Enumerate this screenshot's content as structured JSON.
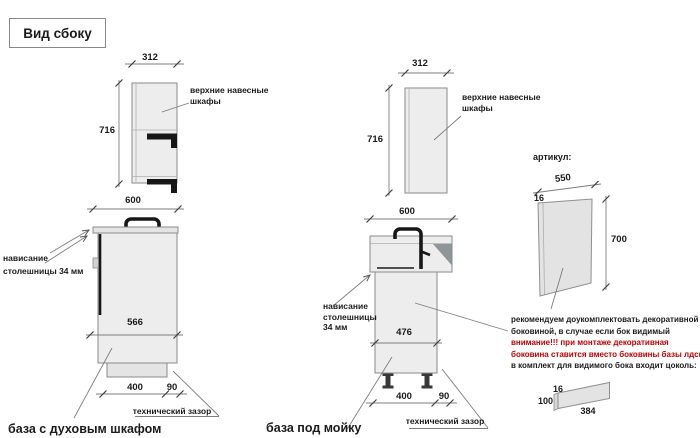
{
  "title": "Вид сбоку",
  "left": {
    "wall": {
      "width": "312",
      "height": "716",
      "label_line1": "верхние навесные",
      "label_line2": "шкафы"
    },
    "base": {
      "width": "600",
      "front_height": "566",
      "door_width": "400",
      "gap": "90",
      "overhang_line1": "нависание",
      "overhang_line2": "столешницы 34 мм",
      "gap_label": "технический зазор",
      "caption": "база с духовым шкафом"
    }
  },
  "middle": {
    "wall": {
      "width": "312",
      "height": "716",
      "label_line1": "верхние навесные",
      "label_line2": "шкафы"
    },
    "base": {
      "width": "600",
      "front_height": "476",
      "door_width": "400",
      "gap": "90",
      "overhang_line1": "нависание",
      "overhang_line2": "столешницы",
      "overhang_line3": "34 мм",
      "gap_label": "технический зазор",
      "caption": "база под мойку"
    }
  },
  "right": {
    "article_label": "артикул:",
    "panel": {
      "width": "550",
      "thickness": "16",
      "height": "700"
    },
    "note": {
      "line1": "рекомендуем доукомплектовать декоративной",
      "line2": "боковиной, в случае если бок видимый",
      "line3": "внимание!!! при монтаже декоративная",
      "line4": "боковина ставится вместо боковины базы лдсп",
      "line5": "в комплект для видимого бока входит цоколь:"
    },
    "plinth": {
      "thickness": "16",
      "height": "100",
      "length": "384"
    }
  },
  "colors": {
    "warning_red": "#c00000",
    "cabinet_fill": "#ededed",
    "sink_shade": "#8f969a",
    "ink": "#1b1b1b"
  }
}
